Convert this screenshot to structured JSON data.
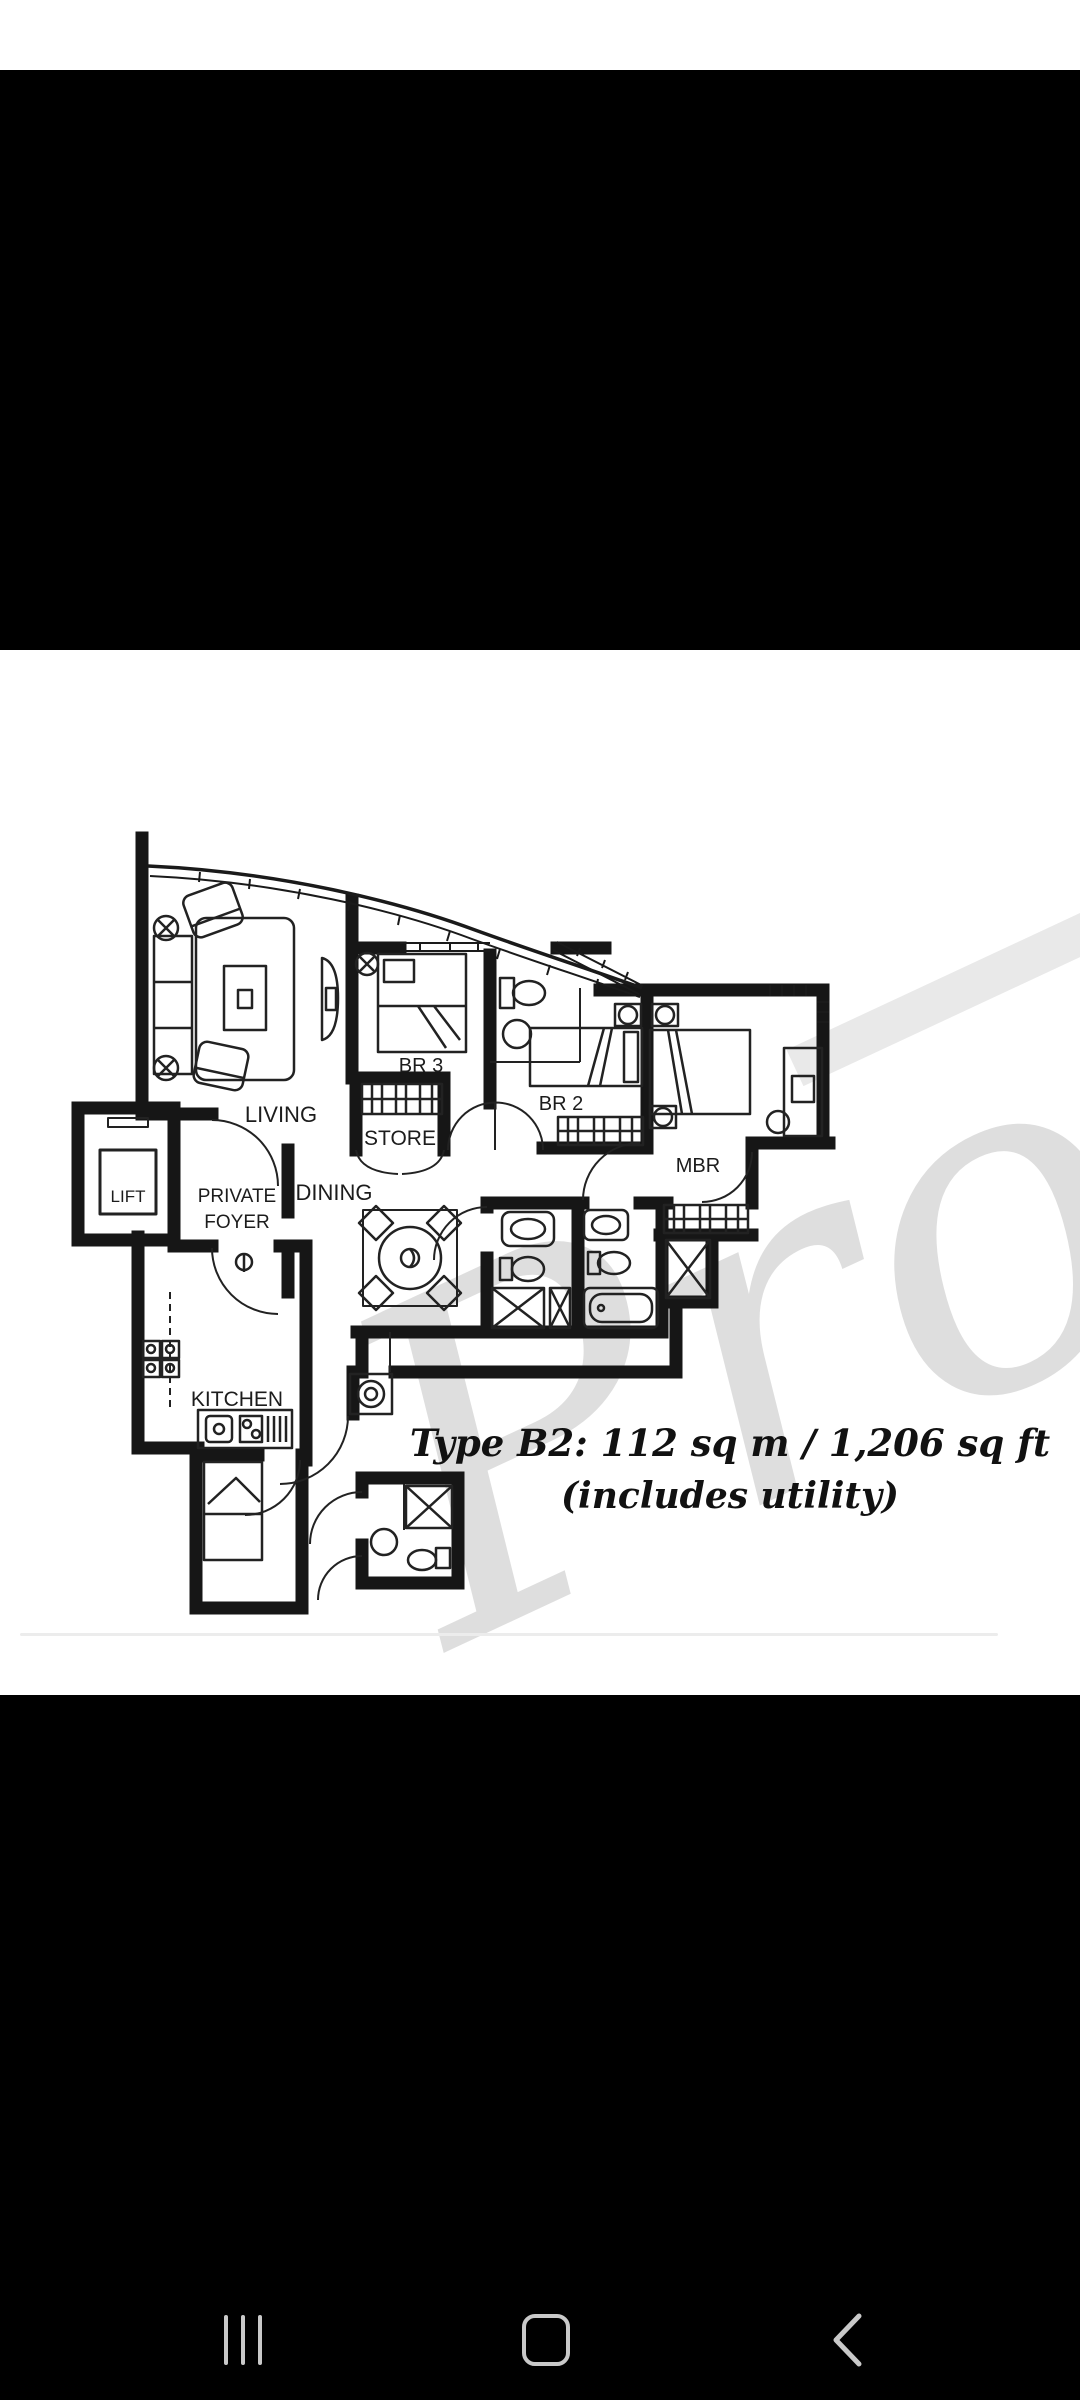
{
  "app": {
    "view": "floor-plan-image-viewer"
  },
  "floor_plan": {
    "room_labels": {
      "living": "LIVING",
      "br3": "BR 3",
      "br2": "BR 2",
      "mbr": "MBR",
      "store": "STORE",
      "dining": "DINING",
      "foyer_line1": "PRIVATE",
      "foyer_line2": "FOYER",
      "lift": "LIFT",
      "kitchen": "KITCHEN"
    },
    "caption": {
      "line1": "Type B2: 112 sq m / 1,206 sq ft",
      "line2": "(includes utility)"
    },
    "watermark": "Prop"
  },
  "colors": {
    "ink": "#1a1a1a",
    "watermark_gray": "#d2d2d2",
    "watermark_band": "#e9e9e9",
    "nav_icon": "#c9c9c9",
    "divider": "#ececec",
    "page_bg": "#ffffff",
    "letterbox": "#000000"
  },
  "nav": {
    "recents": "Recents",
    "home": "Home",
    "back": "Back"
  }
}
